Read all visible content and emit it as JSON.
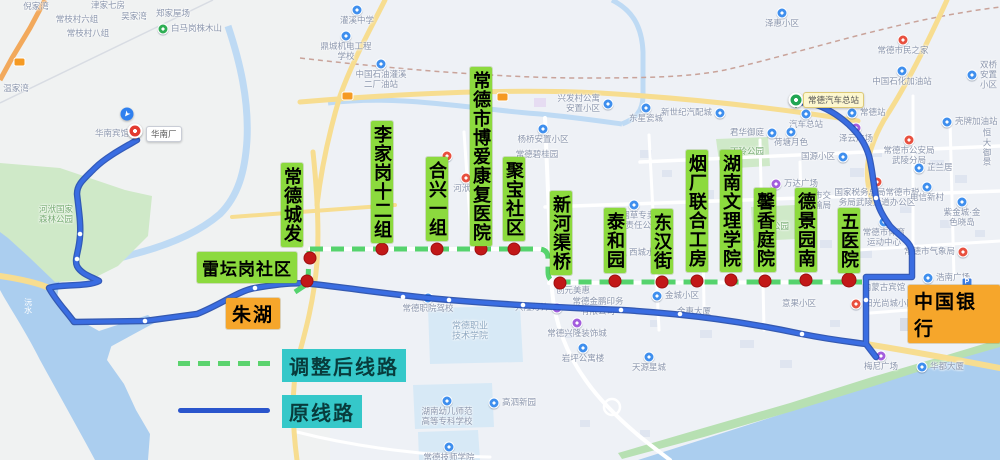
{
  "legend": {
    "adjusted_label": "调整后线路",
    "original_label": "原线路"
  },
  "colors": {
    "adjusted_route": "#55d36d",
    "original_route": "#3a6de2",
    "original_route_casing": "#1f4ab2",
    "stop_dot": "#c21818",
    "stop_label_bg": "#8cda3e",
    "terminal_label_bg": "#f6a62b",
    "legend_label_bg": "#35c8c9",
    "water": "#abceef",
    "park": "#cfe9c8"
  },
  "pins": {
    "start": {
      "name": "常德汽车总站"
    },
    "end": {
      "name": "华南厂"
    }
  },
  "terminals": [
    {
      "name": "朱湖",
      "x": 226,
      "y": 298
    },
    {
      "name": "中国银行",
      "x": 908,
      "y": 285
    }
  ],
  "stops": [
    {
      "name": "常德城发",
      "dot": [
        310,
        258
      ],
      "label": [
        281,
        163
      ],
      "orient": "v"
    },
    {
      "name": "雷坛岗社区",
      "dot": [
        307,
        281
      ],
      "label": [
        197,
        252
      ],
      "orient": "h"
    },
    {
      "name": "李家岗十二组",
      "dot": [
        382,
        249
      ],
      "label": [
        371,
        121
      ],
      "orient": "v"
    },
    {
      "name": "合兴一组",
      "dot": [
        437,
        249
      ],
      "label": [
        426,
        157
      ],
      "orient": "v"
    },
    {
      "name": "常德市博爱康复医院",
      "dot": [
        481,
        249
      ],
      "label": [
        470,
        67
      ],
      "orient": "v"
    },
    {
      "name": "聚宝社区",
      "dot": [
        514,
        249
      ],
      "label": [
        503,
        157
      ],
      "orient": "v"
    },
    {
      "name": "新河渠桥",
      "dot": [
        560,
        283
      ],
      "label": [
        550,
        191
      ],
      "orient": "v"
    },
    {
      "name": "泰和园",
      "dot": [
        615,
        281
      ],
      "label": [
        604,
        208
      ],
      "orient": "v"
    },
    {
      "name": "东汉街",
      "dot": [
        662,
        282
      ],
      "label": [
        651,
        209
      ],
      "orient": "v"
    },
    {
      "name": "烟厂联合工房",
      "dot": [
        697,
        281
      ],
      "label": [
        686,
        150
      ],
      "orient": "v"
    },
    {
      "name": "湖南文理学院",
      "dot": [
        731,
        280
      ],
      "label": [
        720,
        150
      ],
      "orient": "v"
    },
    {
      "name": "馨香庭院",
      "dot": [
        765,
        281
      ],
      "label": [
        754,
        188
      ],
      "orient": "v"
    },
    {
      "name": "德景园南",
      "dot": [
        806,
        280
      ],
      "label": [
        795,
        188
      ],
      "orient": "v"
    },
    {
      "name": "五医院",
      "dot": [
        849,
        280
      ],
      "label": [
        838,
        208
      ],
      "orient": "v"
    }
  ],
  "pois": [
    {
      "n": "倪家湾",
      "x": 36,
      "y": 7,
      "ic": "none"
    },
    {
      "n": "津家七房",
      "x": 108,
      "y": 6,
      "ic": "none"
    },
    {
      "n": "吴家湾",
      "x": 134,
      "y": 17,
      "ic": "none"
    },
    {
      "n": "郑家屋场",
      "x": 173,
      "y": 14,
      "ic": "none"
    },
    {
      "n": "常枝村六组",
      "x": 77,
      "y": 20,
      "ic": "none"
    },
    {
      "n": "常枝村八组",
      "x": 88,
      "y": 34,
      "ic": "none"
    },
    {
      "n": "白马岗株木山",
      "x": 163,
      "y": 29,
      "ic": "g",
      "tp": "r"
    },
    {
      "n": "温家湾",
      "x": 16,
      "y": 89,
      "ic": "none"
    },
    {
      "n": "华南宾馆",
      "x": 112,
      "y": 134,
      "ic": "none"
    },
    {
      "n": "河洑国家\n森林公园",
      "x": 56,
      "y": 215,
      "ic": "park"
    },
    {
      "n": "沅水",
      "x": 28,
      "y": 306,
      "ic": "river"
    },
    {
      "n": "灌溪中学",
      "x": 357,
      "y": 10,
      "ic": "b",
      "tp": "b"
    },
    {
      "n": "鼎城机电工程\n学校",
      "x": 346,
      "y": 36,
      "ic": "b",
      "tp": "b"
    },
    {
      "n": "中国石油灌溪\n二厂油站",
      "x": 381,
      "y": 64,
      "ic": "b",
      "tp": "b"
    },
    {
      "n": "杨桥安置小区",
      "x": 543,
      "y": 129,
      "ic": "b",
      "tp": "b"
    },
    {
      "n": "常德碧桂园",
      "x": 537,
      "y": 155,
      "ic": "none"
    },
    {
      "n": "河洑镇",
      "x": 466,
      "y": 178,
      "ic": "r",
      "tp": "b"
    },
    {
      "n": "",
      "x": 447,
      "y": 156,
      "ic": "r",
      "tp": "n"
    },
    {
      "n": "兴发村公寓\n安置小区",
      "x": 608,
      "y": 104,
      "ic": "b",
      "tp": "l"
    },
    {
      "n": "东星瓷城",
      "x": 646,
      "y": 108,
      "ic": "b",
      "tp": "b"
    },
    {
      "n": "新世纪汽配城",
      "x": 720,
      "y": 113,
      "ic": "b",
      "tp": "l"
    },
    {
      "n": "泽惠小区",
      "x": 782,
      "y": 13,
      "ic": "b",
      "tp": "b"
    },
    {
      "n": "君华御庭",
      "x": 772,
      "y": 133,
      "ic": "b",
      "tp": "l"
    },
    {
      "n": "丁玲公园",
      "x": 747,
      "y": 152,
      "ic": "park"
    },
    {
      "n": "荷塘月色",
      "x": 791,
      "y": 132,
      "ic": "b",
      "tp": "b"
    },
    {
      "n": "常德站",
      "x": 852,
      "y": 113,
      "ic": "b",
      "tp": "r"
    },
    {
      "n": "汽车总站",
      "x": 806,
      "y": 114,
      "ic": "b",
      "tp": "b"
    },
    {
      "n": "泽云广场",
      "x": 856,
      "y": 128,
      "ic": "p",
      "tp": "b"
    },
    {
      "n": "中国石化加油站",
      "x": 902,
      "y": 71,
      "ic": "b",
      "tp": "b"
    },
    {
      "n": "常德市民之家",
      "x": 903,
      "y": 40,
      "ic": "r",
      "tp": "b"
    },
    {
      "n": "双桥安置小区",
      "x": 972,
      "y": 75,
      "ic": "b",
      "tp": "r"
    },
    {
      "n": "壳牌加油站",
      "x": 947,
      "y": 122,
      "ic": "b",
      "tp": "r"
    },
    {
      "n": "常德市公安局\n武陵分局",
      "x": 909,
      "y": 140,
      "ic": "r",
      "tp": "b"
    },
    {
      "n": "恒大御景",
      "x": 987,
      "y": 148,
      "ic": "none"
    },
    {
      "n": "国源小区",
      "x": 843,
      "y": 157,
      "ic": "b",
      "tp": "l"
    },
    {
      "n": "芷兰居",
      "x": 919,
      "y": 168,
      "ic": "b",
      "tp": "r"
    },
    {
      "n": "国家税务总局常德市税\n务局武陵大道办公区",
      "x": 877,
      "y": 182,
      "ic": "r",
      "tp": "b"
    },
    {
      "n": "电信新村",
      "x": 927,
      "y": 187,
      "ic": "b",
      "tp": "b"
    },
    {
      "n": "紫金城·金色晓岛",
      "x": 962,
      "y": 202,
      "ic": "b",
      "tp": "b"
    },
    {
      "n": "常德市体育\n运动中心",
      "x": 884,
      "y": 222,
      "ic": "b",
      "tp": "b"
    },
    {
      "n": "万达广场",
      "x": 776,
      "y": 184,
      "ic": "p",
      "tp": "r"
    },
    {
      "n": "常德市交\n通运输局",
      "x": 814,
      "y": 201,
      "ic": "none"
    },
    {
      "n": "文化公园",
      "x": 772,
      "y": 227,
      "ic": "park"
    },
    {
      "n": "常德烟草专卖局\n有限责任公司",
      "x": 634,
      "y": 205,
      "ic": "b",
      "tp": "b"
    },
    {
      "n": "西城水芯",
      "x": 621,
      "y": 253,
      "ic": "b",
      "tp": "r"
    },
    {
      "n": "创元美惠",
      "x": 573,
      "y": 291,
      "ic": "none"
    },
    {
      "n": "金城小区",
      "x": 657,
      "y": 296,
      "ic": "b",
      "tp": "r"
    },
    {
      "n": "常德金鹏印务\n有限公司",
      "x": 598,
      "y": 307,
      "ic": "none"
    },
    {
      "n": "金惠大厦",
      "x": 694,
      "y": 312,
      "ic": "none"
    },
    {
      "n": "常德职院驾校",
      "x": 428,
      "y": 298,
      "ic": "b",
      "tp": "b"
    },
    {
      "n": "常德职业\n技术学院",
      "x": 470,
      "y": 331,
      "ic": "campus"
    },
    {
      "n": "兴隆灯饰",
      "x": 557,
      "y": 308,
      "ic": "p",
      "tp": "l"
    },
    {
      "n": "常德兴隆装饰城",
      "x": 577,
      "y": 323,
      "ic": "p",
      "tp": "b"
    },
    {
      "n": "岩坪公寓楼",
      "x": 583,
      "y": 348,
      "ic": "b",
      "tp": "b"
    },
    {
      "n": "天源星城",
      "x": 649,
      "y": 357,
      "ic": "b",
      "tp": "b"
    },
    {
      "n": "湖南幼儿师范\n高等专科学校",
      "x": 447,
      "y": 401,
      "ic": "b",
      "tp": "b"
    },
    {
      "n": "高泗新园",
      "x": 494,
      "y": 403,
      "ic": "b",
      "tp": "r"
    },
    {
      "n": "常德技师学院",
      "x": 449,
      "y": 447,
      "ic": "b",
      "tp": "b"
    },
    {
      "n": "梅尼广场",
      "x": 881,
      "y": 356,
      "ic": "p",
      "tp": "b"
    },
    {
      "n": "华都大厦",
      "x": 922,
      "y": 367,
      "ic": "b",
      "tp": "r"
    },
    {
      "n": "锦都豪苑",
      "x": 964,
      "y": 336,
      "ic": "b",
      "tp": "l"
    },
    {
      "n": "阳光尚城小区",
      "x": 856,
      "y": 304,
      "ic": "r",
      "tp": "r"
    },
    {
      "n": "内蒙古宾馆",
      "x": 884,
      "y": 288,
      "ic": "none"
    },
    {
      "n": "浩南广场",
      "x": 928,
      "y": 278,
      "ic": "b",
      "tp": "r"
    },
    {
      "n": "常德市气象局",
      "x": 963,
      "y": 252,
      "ic": "r",
      "tp": "l"
    },
    {
      "n": "",
      "x": 967,
      "y": 283,
      "ic": "P",
      "tp": "n"
    },
    {
      "n": "意果小区",
      "x": 799,
      "y": 304,
      "ic": "none"
    }
  ]
}
